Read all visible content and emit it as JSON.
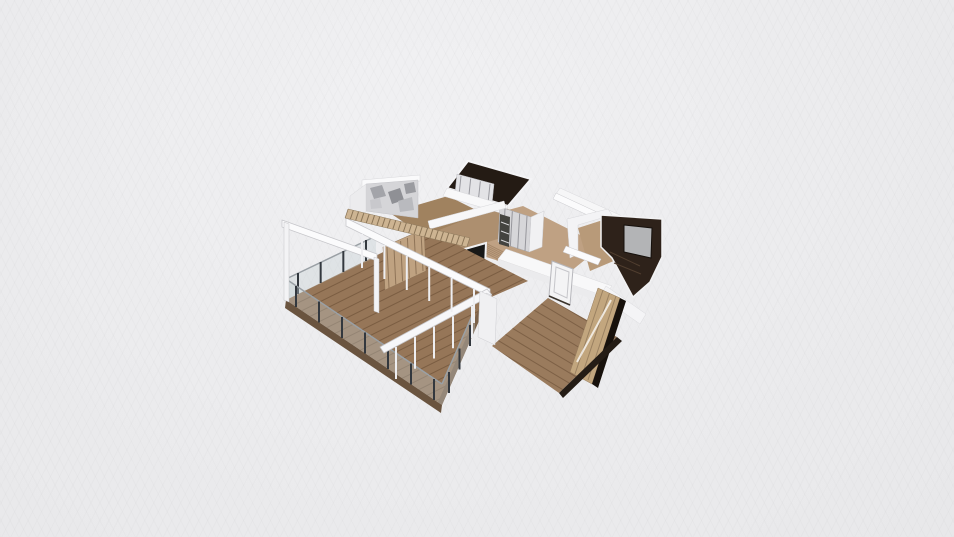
{
  "canvas": {
    "width": 954,
    "height": 537,
    "background": "#ebebed"
  },
  "palette": {
    "background": "#ebebed",
    "wall_white": "#f8f8f9",
    "wall_shade": "#ececee",
    "deck_wood": "#967658",
    "deck_fascia": "#6a543f",
    "hall_wood": "#bfa183",
    "bedroom_wood": "#9a7b5d",
    "slat_wood": "#cdb492",
    "wardrobe_tan": "#c2a67e",
    "dark_room_floor": "#241b14",
    "dark_media_wall": "#2e221a",
    "tv_gray": "#b3b4b6",
    "kitchen_panel_dark": "#181817",
    "railing_post": "#33383e",
    "railing_glass": "rgba(195,205,210,0.35)",
    "marble_gray": "#d5d5d8"
  },
  "scene": {
    "shapes": [
      {
        "t": "poly",
        "n": "hall-floor",
        "id": "hallFloor",
        "p": "448,226 523,206 602,246 560,280 470,252",
        "f": "#bfa183"
      },
      {
        "t": "ticks",
        "n": "hall-plank-seams",
        "clip": "hallFloor",
        "e1": [
          430,
          215,
          540,
          290
        ],
        "e2": [
          600,
          301,
          710,
          376
        ],
        "c": 11,
        "s": "rgba(130,100,70,0.4)",
        "w": 1
      },
      {
        "t": "poly",
        "n": "kitchen-floor",
        "p": "430,229 506,208 540,226 462,250",
        "f": "#ad8f6f"
      },
      {
        "t": "poly",
        "n": "upper-room-floor",
        "p": "390,213 448,196 482,213 424,236",
        "f": "#a0825f"
      },
      {
        "t": "poly",
        "n": "bathroom-dark-floor",
        "p": "468,161 531,179 508,206 447,188",
        "f": "#241b14",
        "s": "#f4f4f6",
        "w": 2
      },
      {
        "t": "poly",
        "n": "bathroom-closet",
        "p": "457,174 494,184 492,204 455,193",
        "f": "#e3e3e6",
        "s": "#b9b9be",
        "w": 0.5
      },
      {
        "t": "ticks",
        "n": "bathroom-closet-seams",
        "e1": [
          461,
          176,
          490,
          184
        ],
        "e2": [
          459,
          195,
          488,
          203
        ],
        "c": 4,
        "s": "#9a9aa0",
        "w": 1
      },
      {
        "t": "poly",
        "n": "bathroom-sw-wall",
        "p": "447,188 508,206 504,214 443,196",
        "f": "#f8f8f9",
        "s": "#d8d8db",
        "w": 0.5
      },
      {
        "t": "poly",
        "n": "hall-ne-wall",
        "p": "560,188 622,216 618,222 556,194",
        "f": "#f6f6f7",
        "s": "#d9d9dc",
        "w": 0.5
      },
      {
        "t": "poly",
        "n": "hall-console-shelf",
        "p": "556,193 599,213 596,219 553,199",
        "f": "#fbfbfc",
        "s": "#c9c9cd",
        "w": 0.5
      },
      {
        "t": "poly",
        "n": "wardrobe-sliding-doors",
        "p": "500,207 531,217 529,252 498,242",
        "f": "#d6d6d9",
        "s": "#aaaaaf",
        "w": 0.5
      },
      {
        "t": "ticks",
        "n": "wardrobe-door-seams",
        "e1": [
          505,
          209,
          527,
          216
        ],
        "e2": [
          503,
          244,
          525,
          251
        ],
        "c": 4,
        "s": "#96969c",
        "w": 1
      },
      {
        "t": "poly",
        "n": "wardrobe-shelf-unit",
        "p": "500,214 510,217 509,247 499,244",
        "f": "#43433f"
      },
      {
        "t": "ticks",
        "n": "wardrobe-shelf-lines",
        "e1": [
          501,
          222,
          501,
          240
        ],
        "e2": [
          509,
          225,
          509,
          243
        ],
        "c": 3,
        "s": "#d9d9db",
        "w": 1
      },
      {
        "t": "poly",
        "n": "wardrobe-side-panel",
        "p": "531,217 544,211 542,247 529,252",
        "f": "#f1f1f3",
        "s": "#d0d0d4",
        "w": 0.5
      },
      {
        "t": "poly",
        "n": "media-room-wall",
        "p": "567,219 608,209 612,215 578,225 578,254 570,258",
        "f": "#f3f3f5",
        "s": "#d8d8db",
        "w": 0.5
      },
      {
        "t": "poly",
        "n": "media-room-floor",
        "p": "578,228 606,219 616,260 590,271",
        "f": "#b89a79"
      },
      {
        "t": "poly",
        "n": "media-wall-dark",
        "p": "601,215 662,219 662,257 650,282 633,297 612,258 601,247",
        "f": "#2e221a",
        "s": "#f2f2f3",
        "w": 1.5
      },
      {
        "t": "poly",
        "n": "media-tv-screen",
        "p": "624,225 652,228 651,258 624,252",
        "f": "#b3b4b6",
        "s": "#15100c",
        "w": 1
      },
      {
        "t": "line",
        "n": "media-shelf-line-1",
        "p": "610,252 640,266",
        "s": "#503e2f",
        "w": 1
      },
      {
        "t": "line",
        "n": "media-shelf-line-2",
        "p": "614,263 641,274",
        "s": "#503e2f",
        "w": 1
      },
      {
        "t": "poly",
        "n": "kitchen-north-wall",
        "p": "428,221 504,201 506,208 430,229",
        "f": "#f7f7f8",
        "s": "#d8d8db",
        "w": 0.5
      },
      {
        "t": "poly",
        "n": "kitchen-cabinet",
        "p": "420,249 446,256 446,299 420,291",
        "f": "#c8ac8a",
        "s": "#9c8265",
        "w": 0.5
      },
      {
        "t": "ticks",
        "n": "kitchen-cabinet-seams",
        "e1": [
          424,
          250,
          443,
          255
        ],
        "e2": [
          424,
          292,
          443,
          298
        ],
        "c": 4,
        "s": "#9c8265",
        "w": 1
      },
      {
        "t": "poly",
        "n": "kitchen-media-panel",
        "p": "447,254 486,243 484,290 447,300",
        "f": "#181817",
        "s": "#f0f0f2",
        "w": 2
      },
      {
        "t": "poly",
        "n": "kitchen-media-reflection",
        "p": "452,262 470,257 469,286 452,292",
        "f": "#5a5a5c",
        "o": 0.5
      },
      {
        "t": "poly",
        "n": "marble-top-band",
        "p": "362,180 420,175 420,181 362,187",
        "f": "#fafafb",
        "s": "#d8d8db",
        "w": 0.5
      },
      {
        "t": "poly",
        "n": "marble-accent-wall",
        "id": "marbleWall",
        "p": "366,184 418,180 418,218 366,211",
        "f": "#d5d5d8",
        "s": "#c3c3c7",
        "w": 0.5
      },
      {
        "t": "poly",
        "n": "marble-vein-1",
        "p": "370,188 382,185 386,196 374,199",
        "f": "#a3a4a9"
      },
      {
        "t": "poly",
        "n": "marble-vein-2",
        "p": "388,192 400,188 404,200 392,204",
        "f": "#8f9095"
      },
      {
        "t": "poly",
        "n": "marble-vein-3",
        "p": "398,201 412,197 414,210 400,212",
        "f": "#b9babe"
      },
      {
        "t": "poly",
        "n": "marble-vein-4",
        "p": "370,200 380,198 382,208 371,209",
        "f": "#c8c8cc"
      },
      {
        "t": "poly",
        "n": "marble-vein-5",
        "p": "404,184 414,182 416,192 406,194",
        "f": "#9a9ba0"
      },
      {
        "t": "poly",
        "n": "marble-left-wall",
        "p": "350,196 366,184 366,212 350,224",
        "f": "#ececee",
        "s": "#d8d8db",
        "w": 0.5
      },
      {
        "t": "poly",
        "n": "living-terrace-floor",
        "id": "mainFloor",
        "p": "286,300 428,230 528,281 489,298 442,405",
        "f": "#967658"
      },
      {
        "t": "ticks",
        "n": "deck-plank-seams",
        "clip": "mainFloor",
        "e1": [
          276,
          304,
          452,
          422
        ],
        "e2": [
          462,
          212,
          638,
          330
        ],
        "c": 22,
        "s": "rgba(82,58,36,0.4)",
        "w": 1
      },
      {
        "t": "poly",
        "n": "deck-fascia-sw",
        "p": "286,300 442,405 441,413 285,308",
        "f": "#6a543f"
      },
      {
        "t": "poly",
        "n": "deck-fascia-se",
        "p": "489,298 442,405 438,402 485,295",
        "f": "#7b624a"
      },
      {
        "t": "poly",
        "n": "living-slat-wall",
        "p": "383,247 424,229 426,271 385,290",
        "f": "#bfa281",
        "s": "#8f7458",
        "w": 0.5
      },
      {
        "t": "ticks",
        "n": "living-slat-seams",
        "e1": [
          387,
          247,
          421,
          232
        ],
        "e2": [
          389,
          288,
          423,
          271
        ],
        "c": 6,
        "s": "#8f7458",
        "w": 1
      },
      {
        "t": "poly",
        "n": "railing-glass-nw",
        "p": "286,279 376,236 376,257 286,300",
        "f": "rgba(195,205,210,0.35)"
      },
      {
        "t": "line",
        "n": "railing-rail-nw",
        "p": "286,279 376,236",
        "s": "#9aa0a5",
        "w": 1.5
      },
      {
        "t": "ticks",
        "n": "railing-posts-nw",
        "e1": [
          298,
          273,
          366,
          240
        ],
        "e2": [
          298,
          294,
          366,
          261
        ],
        "c": 4,
        "s": "#33383e",
        "w": 2
      },
      {
        "t": "poly",
        "n": "railing-glass-sw",
        "p": "286,279 442,384 442,405 286,300",
        "f": "rgba(195,205,210,0.35)"
      },
      {
        "t": "line",
        "n": "railing-rail-sw",
        "p": "286,279 442,384",
        "s": "#9aa0a5",
        "w": 1.5
      },
      {
        "t": "ticks",
        "n": "railing-posts-sw",
        "e1": [
          296,
          286,
          434,
          379
        ],
        "e2": [
          296,
          307,
          434,
          400
        ],
        "c": 7,
        "s": "#33383e",
        "w": 2
      },
      {
        "t": "poly",
        "n": "railing-glass-se",
        "p": "475,309 442,384 442,405 475,330",
        "f": "rgba(195,205,210,0.35)"
      },
      {
        "t": "line",
        "n": "railing-rail-se",
        "p": "475,309 442,384",
        "s": "#9aa0a5",
        "w": 1.5
      },
      {
        "t": "ticks",
        "n": "railing-posts-se",
        "e1": [
          449,
          372,
          470,
          325
        ],
        "e2": [
          449,
          393,
          470,
          346
        ],
        "c": 3,
        "s": "#33383e",
        "w": 2
      },
      {
        "t": "poly",
        "n": "pergola-beam-nw",
        "p": "282,220 377,254 377,261 282,227",
        "f": "#fbfbfc",
        "s": "#c6c6ca",
        "w": 0.75
      },
      {
        "t": "poly",
        "n": "pergola-beam-ne",
        "p": "346,218 490,289 490,297 346,226",
        "f": "#fbfbfc",
        "s": "#c6c6ca",
        "w": 0.75
      },
      {
        "t": "poly",
        "n": "pergola-beam-se",
        "p": "487,289 492,295 384,353 380,347",
        "f": "#f7f7f9",
        "s": "#c6c6ca",
        "w": 0.75
      },
      {
        "t": "poly",
        "n": "pergola-post-west",
        "p": "284,222 289,224 289,302 284,300",
        "f": "#f3f3f5",
        "s": "#c6c6ca",
        "w": 0.5
      },
      {
        "t": "poly",
        "n": "pergola-post-mid",
        "p": "374,257 379,259 379,313 374,311",
        "f": "#f3f3f5",
        "s": "#c6c6ca",
        "w": 0.5
      },
      {
        "t": "poly",
        "n": "pergola-post-east",
        "p": "486,293 491,295 491,333 486,331",
        "f": "#f3f3f5",
        "s": "#c6c6ca",
        "w": 0.5
      },
      {
        "t": "ticks",
        "n": "glass-mullions-ne",
        "e1": [
          362,
          234,
          474,
          289
        ],
        "e2": [
          362,
          268,
          474,
          323
        ],
        "c": 6,
        "s": "#eeeef1",
        "w": 2
      },
      {
        "t": "ticks",
        "n": "glass-mullions-se",
        "e1": [
          472,
          306,
          396,
          347
        ],
        "e2": [
          472,
          338,
          396,
          379
        ],
        "c": 5,
        "s": "#eeeef1",
        "w": 2
      },
      {
        "t": "poly",
        "n": "stair-slat-bridge",
        "id": "stairStrip",
        "p": "348,209 470,238 467,247 345,218",
        "f": "#cdb492",
        "s": "#8f7b5e",
        "w": 0.5
      },
      {
        "t": "ticks",
        "n": "stair-slat-rungs",
        "clip": "stairStrip",
        "e1": [
          348,
          209,
          470,
          238
        ],
        "e2": [
          345,
          218,
          467,
          247
        ],
        "c": 24,
        "s": "#8a7457",
        "w": 1
      },
      {
        "t": "poly",
        "n": "bedroom-nw-wall",
        "p": "506,249 612,286 604,296 498,259",
        "f": "#f8f8f9",
        "s": "#dadadd",
        "w": 0.5
      },
      {
        "t": "poly",
        "n": "bedroom-nw-wall-face",
        "p": "498,259 604,296 604,303 498,266",
        "f": "#ebebed"
      },
      {
        "t": "poly",
        "n": "bedroom-ne-wall",
        "p": "606,286 646,314 640,324 600,296",
        "f": "#f4f4f6",
        "s": "#dadadd",
        "w": 0.5
      },
      {
        "t": "poly",
        "n": "bedroom-console",
        "p": "566,246 601,259 598,265 563,252",
        "f": "#fbfbfc",
        "s": "#c9c9cd",
        "w": 0.5
      },
      {
        "t": "poly",
        "n": "bedroom-door",
        "p": "552,261 573,269 570,305 549,296",
        "f": "#f4f4f5",
        "s": "#b6b6bb",
        "w": 1
      },
      {
        "t": "poly",
        "n": "bedroom-door-frame",
        "p": "556,267 569,272 567,298 554,292",
        "f": "none",
        "s": "#c6c6ca",
        "w": 1
      },
      {
        "t": "line",
        "n": "bedroom-door-threshold",
        "p": "549,296 570,305",
        "s": "#3a332b",
        "w": 1.5
      },
      {
        "t": "poly",
        "n": "bedroom-floor",
        "id": "bedroomFloor",
        "p": "548,298 617,337 559,393 492,346",
        "f": "#9a7b5d"
      },
      {
        "t": "ticks",
        "n": "bedroom-plank-seams",
        "clip": "bedroomFloor",
        "e1": [
          560,
          284,
          480,
          340
        ],
        "e2": [
          700,
          368,
          620,
          424
        ],
        "c": 11,
        "s": "rgba(82,58,36,0.4)",
        "w": 1
      },
      {
        "t": "poly",
        "n": "bedroom-wardrobe",
        "p": "598,288 620,298 592,384 570,372",
        "f": "#c2a67e",
        "s": "#957b5c",
        "w": 0.5
      },
      {
        "t": "ticks",
        "n": "bedroom-wardrobe-seams",
        "e1": [
          603,
          290,
          616,
          296
        ],
        "e2": [
          575,
          374,
          588,
          380
        ],
        "c": 3,
        "s": "#9a8161",
        "w": 1
      },
      {
        "t": "line",
        "n": "bedroom-wardrobe-mirror",
        "p": "611,300 577,362",
        "s": "rgba(255,255,255,0.75)",
        "w": 2
      },
      {
        "t": "poly",
        "n": "bedroom-wardrobe-side",
        "p": "620,298 626,301 598,388 592,384",
        "f": "#17110c"
      },
      {
        "t": "poly",
        "n": "bedroom-baseboard",
        "p": "617,337 622,341 563,398 559,393",
        "f": "#241c15"
      },
      {
        "t": "poly",
        "n": "corridor-wall-segment",
        "p": "480,291 497,299 495,345 478,337",
        "f": "#f0f0f2",
        "s": "#cfcfd3",
        "w": 0.5
      }
    ]
  }
}
